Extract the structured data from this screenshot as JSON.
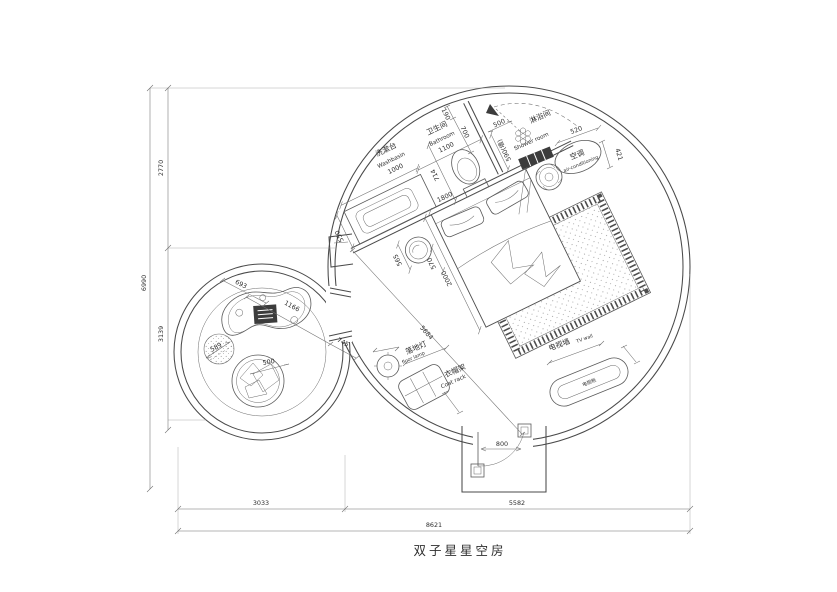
{
  "title": "双子星星空房",
  "colors": {
    "line": "#4a4a4a",
    "dark_fill": "#3c3c3c",
    "background": "#ffffff"
  },
  "rooms": {
    "washbasin": {
      "cn": "洗漱台",
      "en": "Washbasin",
      "dim": "1000"
    },
    "bathroom": {
      "cn": "卫生间",
      "en": "Bathroom",
      "dim": "1100"
    },
    "shower": {
      "cn": "淋浴间",
      "en": "Shower room"
    },
    "ac": {
      "cn": "空调",
      "en": "air-conditioning"
    },
    "floor_lamp": {
      "cn": "落地灯",
      "en": "floor lamp",
      "dim": "310"
    },
    "coat_rack": {
      "cn": "衣帽架",
      "en": "Coat rack",
      "width": "660",
      "depth": "400"
    },
    "tv_wall": {
      "cn": "电视墙",
      "en": "TV wall",
      "width": "1200",
      "depth": "400"
    },
    "tv_cabinet": {
      "cn": "电视柜"
    }
  },
  "dims": {
    "left_total": "6990",
    "left_top": "2770",
    "left_bottom": "3139",
    "bottom_left": "3033",
    "bottom_right": "5582",
    "bottom_total": "8621",
    "d190": "190",
    "d700": "700",
    "d500_shower": "500",
    "d590": "590(墙)",
    "d520": "520",
    "d421": "421",
    "d550": "550",
    "d714": "714",
    "d1800": "1800",
    "d565": "565",
    "d570": "570",
    "d2000": "2000",
    "d5684": "5684",
    "d800": "800",
    "d693": "693",
    "d1166": "1166",
    "d745": "745",
    "d589": "589",
    "d500_pouf": "500"
  }
}
